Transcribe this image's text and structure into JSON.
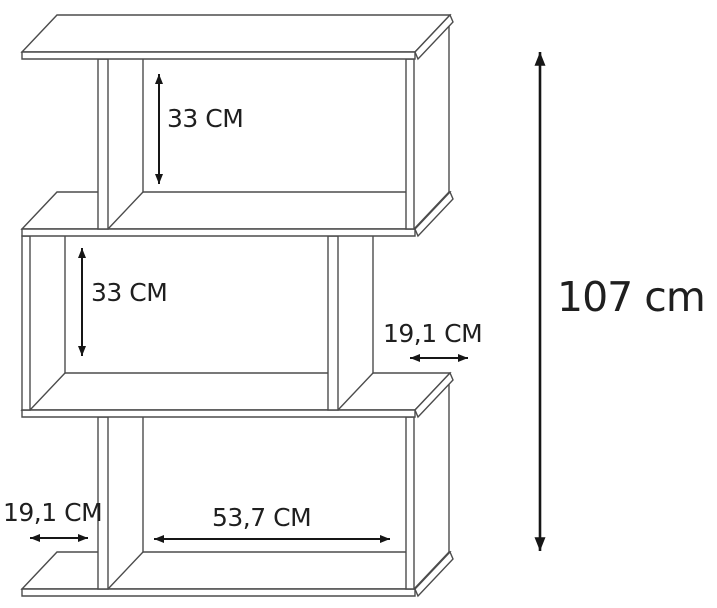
{
  "diagram": {
    "dimensions": {
      "top_compartment_height": "33 CM",
      "middle_compartment_height": "33 CM",
      "side_depth_right": "19,1 CM",
      "side_depth_bottom_left": "19,1 CM",
      "bottom_compartment_width": "53,7 CM",
      "total_height": "107 cm"
    },
    "colors": {
      "background": "#ffffff",
      "outline": "#4c4c4c",
      "dimension_lines": "#161616",
      "label_text": "#1f1f1f"
    }
  }
}
